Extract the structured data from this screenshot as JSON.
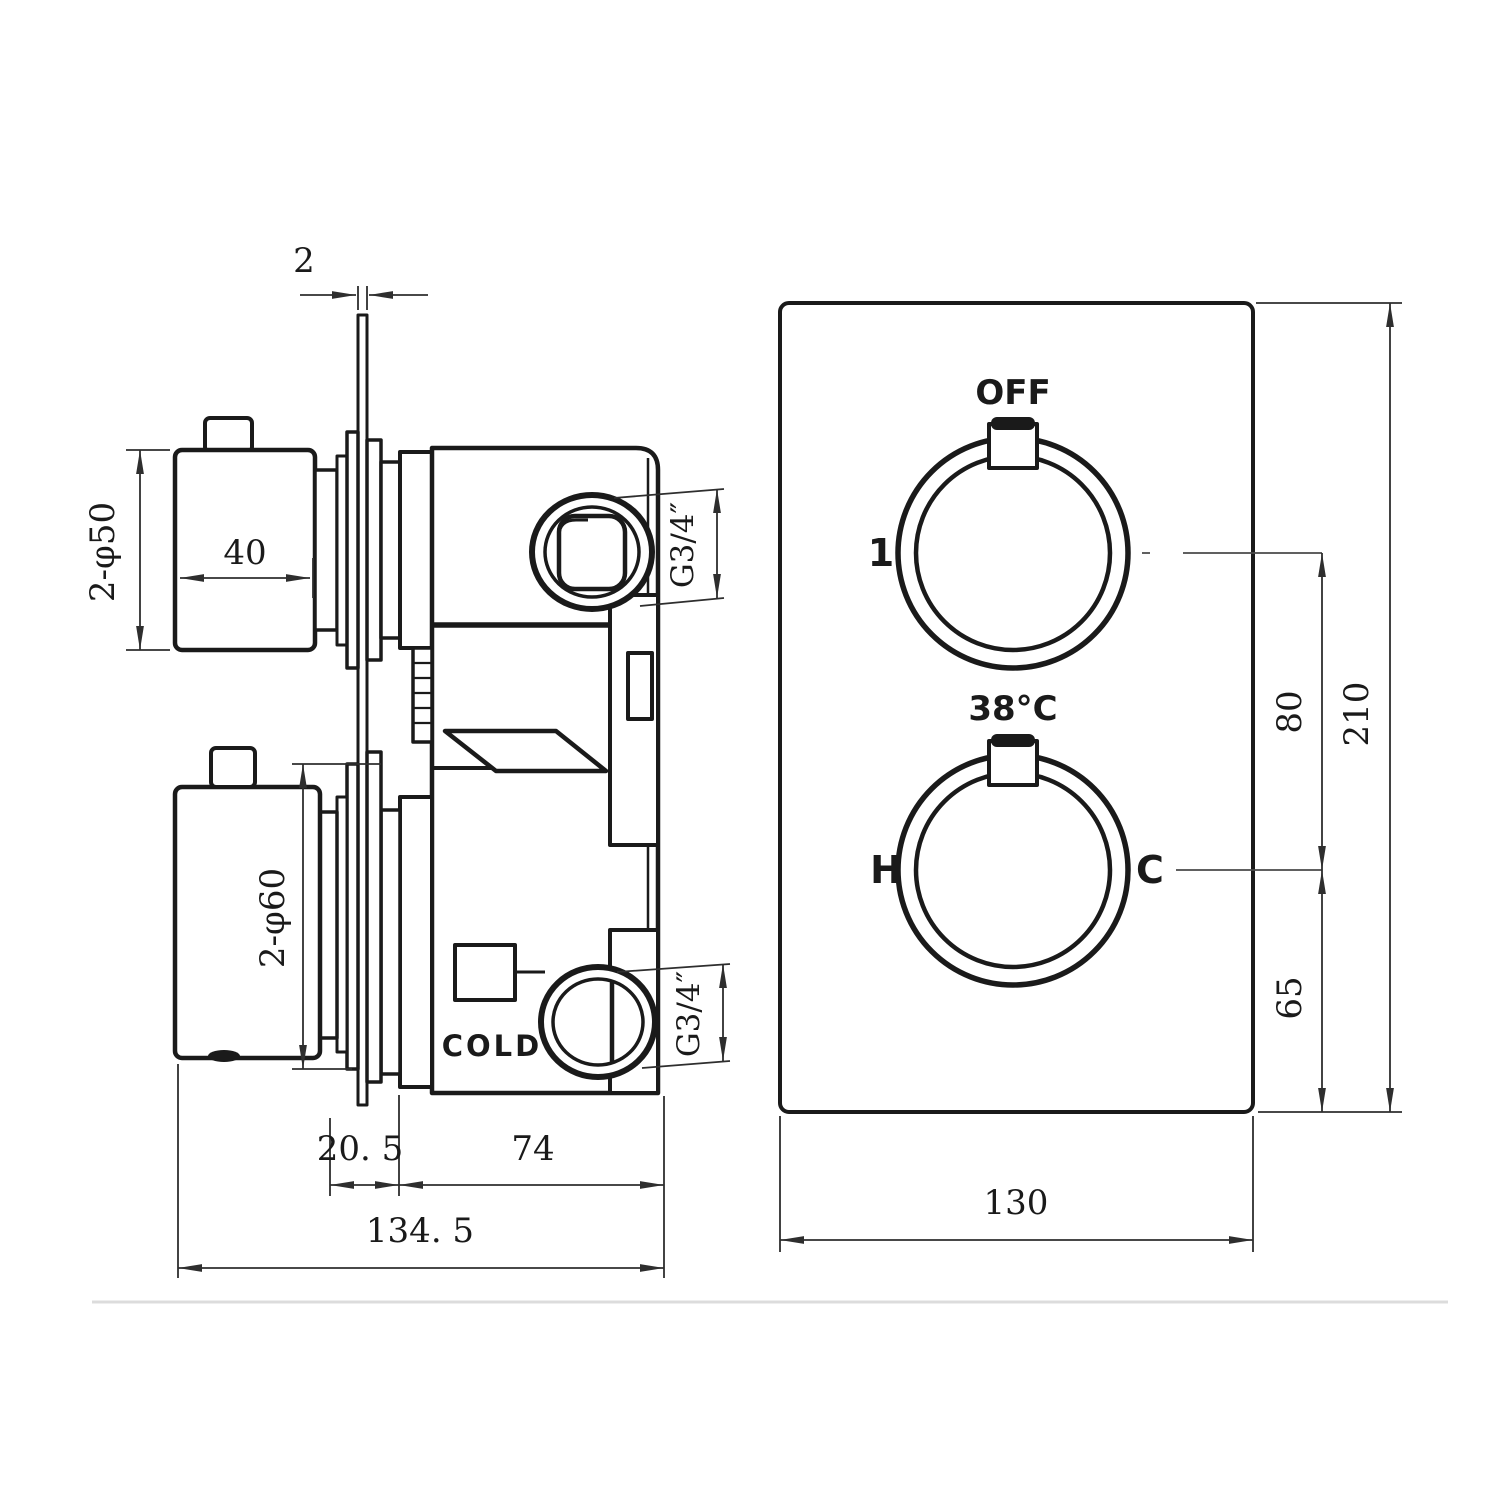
{
  "side_view": {
    "plate_thickness": "2",
    "upper_handle_diameter": "2-φ50",
    "upper_handle_length": "40",
    "lower_handle_diameter": "2-φ60",
    "outlet_thread": "G3/4″",
    "inlet_thread": "G3/4″",
    "cold_label": "COLD",
    "plate_to_body": "20. 5",
    "body_depth": "74",
    "overall_depth": "134. 5"
  },
  "front_view": {
    "off_label": "OFF",
    "diverter_position_label": "1",
    "temperature_label": "38°C",
    "hot_label": "H",
    "cold_label": "C",
    "knob_spacing": "80",
    "bottom_offset": "65",
    "plate_height": "210",
    "plate_width": "130"
  },
  "colors": {
    "line": "#1a1a1a",
    "dim": "#2e2e2e",
    "background": "#ffffff",
    "faint_rule": "#dcdcdc"
  }
}
